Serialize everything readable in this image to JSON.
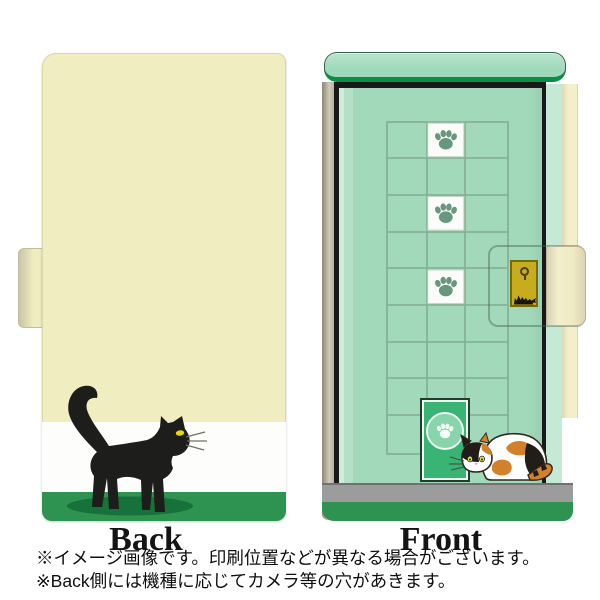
{
  "views": {
    "back": {
      "label": "Back"
    },
    "front": {
      "label": "Front"
    }
  },
  "notes": [
    "※イメージ画像です。印刷位置などが異なる場合がございます。",
    "※Back側には機種に応じてカメラ等の穴があきます。"
  ],
  "colors": {
    "case_cream": "#f0edc0",
    "front_mint": "#a3d9bb",
    "bar_green_border": "#0e8d46",
    "stripe_green": "#2e9351",
    "door_green": "#3ab474",
    "floor_gray": "#9c9c9c",
    "clasp_gold": "#c7ad1e",
    "cat_black": "#1d1d1b",
    "calico_orange": "#d3802b",
    "eye_yellow": "#eed908"
  },
  "icons": {
    "paw": "paw-print-icon",
    "keyhole": "keyhole-icon",
    "clasp_emblem": "cat-silhouette-icon"
  }
}
